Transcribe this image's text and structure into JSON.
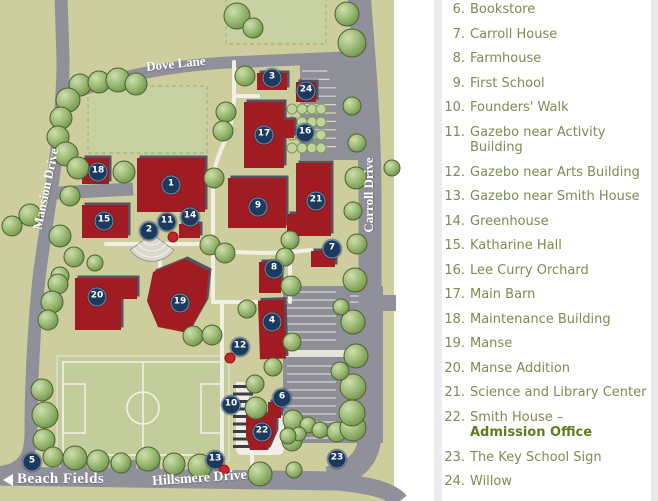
{
  "legend": {
    "items": [
      {
        "num": "6.",
        "label": "Bookstore"
      },
      {
        "num": "7.",
        "label": "Carroll House"
      },
      {
        "num": "8.",
        "label": "Farmhouse"
      },
      {
        "num": "9.",
        "label": "First School"
      },
      {
        "num": "10.",
        "label": "Founders' Walk"
      },
      {
        "num": "11.",
        "label": "Gazebo near Activity Building"
      },
      {
        "num": "12.",
        "label": "Gazebo near Arts Building"
      },
      {
        "num": "13.",
        "label": "Gazebo near Smith House"
      },
      {
        "num": "14.",
        "label": "Greenhouse"
      },
      {
        "num": "15.",
        "label": "Katharine Hall"
      },
      {
        "num": "16.",
        "label": "Lee Curry Orchard"
      },
      {
        "num": "17.",
        "label": "Main Barn"
      },
      {
        "num": "18.",
        "label": "Maintenance Building"
      },
      {
        "num": "19.",
        "label": "Manse"
      },
      {
        "num": "20.",
        "label": "Manse Addition"
      },
      {
        "num": "21.",
        "label": "Science and Library Center"
      },
      {
        "num": "22.",
        "label": "Smith House –",
        "label_bold": "Admission Office"
      },
      {
        "num": "23.",
        "label": "The Key School Sign"
      },
      {
        "num": "24.",
        "label": "Willow"
      }
    ]
  },
  "map": {
    "road_labels": [
      {
        "text": "Dove Lane"
      },
      {
        "text": "Mansion Drive"
      },
      {
        "text": "Carroll Drive"
      },
      {
        "text": "Hillsmere Drive"
      },
      {
        "text": "Beach Fields"
      }
    ],
    "markers": [
      {
        "n": "1",
        "x": 171,
        "y": 185
      },
      {
        "n": "2",
        "x": 149,
        "y": 231
      },
      {
        "n": "3",
        "x": 272,
        "y": 78
      },
      {
        "n": "4",
        "x": 272,
        "y": 322
      },
      {
        "n": "5",
        "x": 32,
        "y": 462
      },
      {
        "n": "6",
        "x": 282,
        "y": 398
      },
      {
        "n": "7",
        "x": 332,
        "y": 249
      },
      {
        "n": "8",
        "x": 274,
        "y": 269
      },
      {
        "n": "9",
        "x": 258,
        "y": 207
      },
      {
        "n": "10",
        "x": 231,
        "y": 405
      },
      {
        "n": "11",
        "x": 167,
        "y": 222
      },
      {
        "n": "12",
        "x": 240,
        "y": 347
      },
      {
        "n": "13",
        "x": 215,
        "y": 460
      },
      {
        "n": "14",
        "x": 190,
        "y": 217
      },
      {
        "n": "15",
        "x": 104,
        "y": 221
      },
      {
        "n": "16",
        "x": 305,
        "y": 133
      },
      {
        "n": "17",
        "x": 264,
        "y": 135
      },
      {
        "n": "18",
        "x": 98,
        "y": 172
      },
      {
        "n": "19",
        "x": 180,
        "y": 303
      },
      {
        "n": "20",
        "x": 97,
        "y": 297
      },
      {
        "n": "21",
        "x": 316,
        "y": 201
      },
      {
        "n": "22",
        "x": 262,
        "y": 432
      },
      {
        "n": "23",
        "x": 337,
        "y": 459
      },
      {
        "n": "24",
        "x": 306,
        "y": 91
      }
    ],
    "gazebo_dots": [
      {
        "x": 173,
        "y": 237
      },
      {
        "x": 230,
        "y": 358
      },
      {
        "x": 224,
        "y": 470
      }
    ],
    "colors": {
      "ground": "#cecd9e",
      "road": "#90909a",
      "building": "#a01f24",
      "marker": "#1c3a5e",
      "tree": "#8fb266",
      "field": "#c7d1a2",
      "gazebo_dot": "#c3252b",
      "legend_text": "#7d8c52",
      "legend_accent": "#5e7c1e"
    }
  }
}
